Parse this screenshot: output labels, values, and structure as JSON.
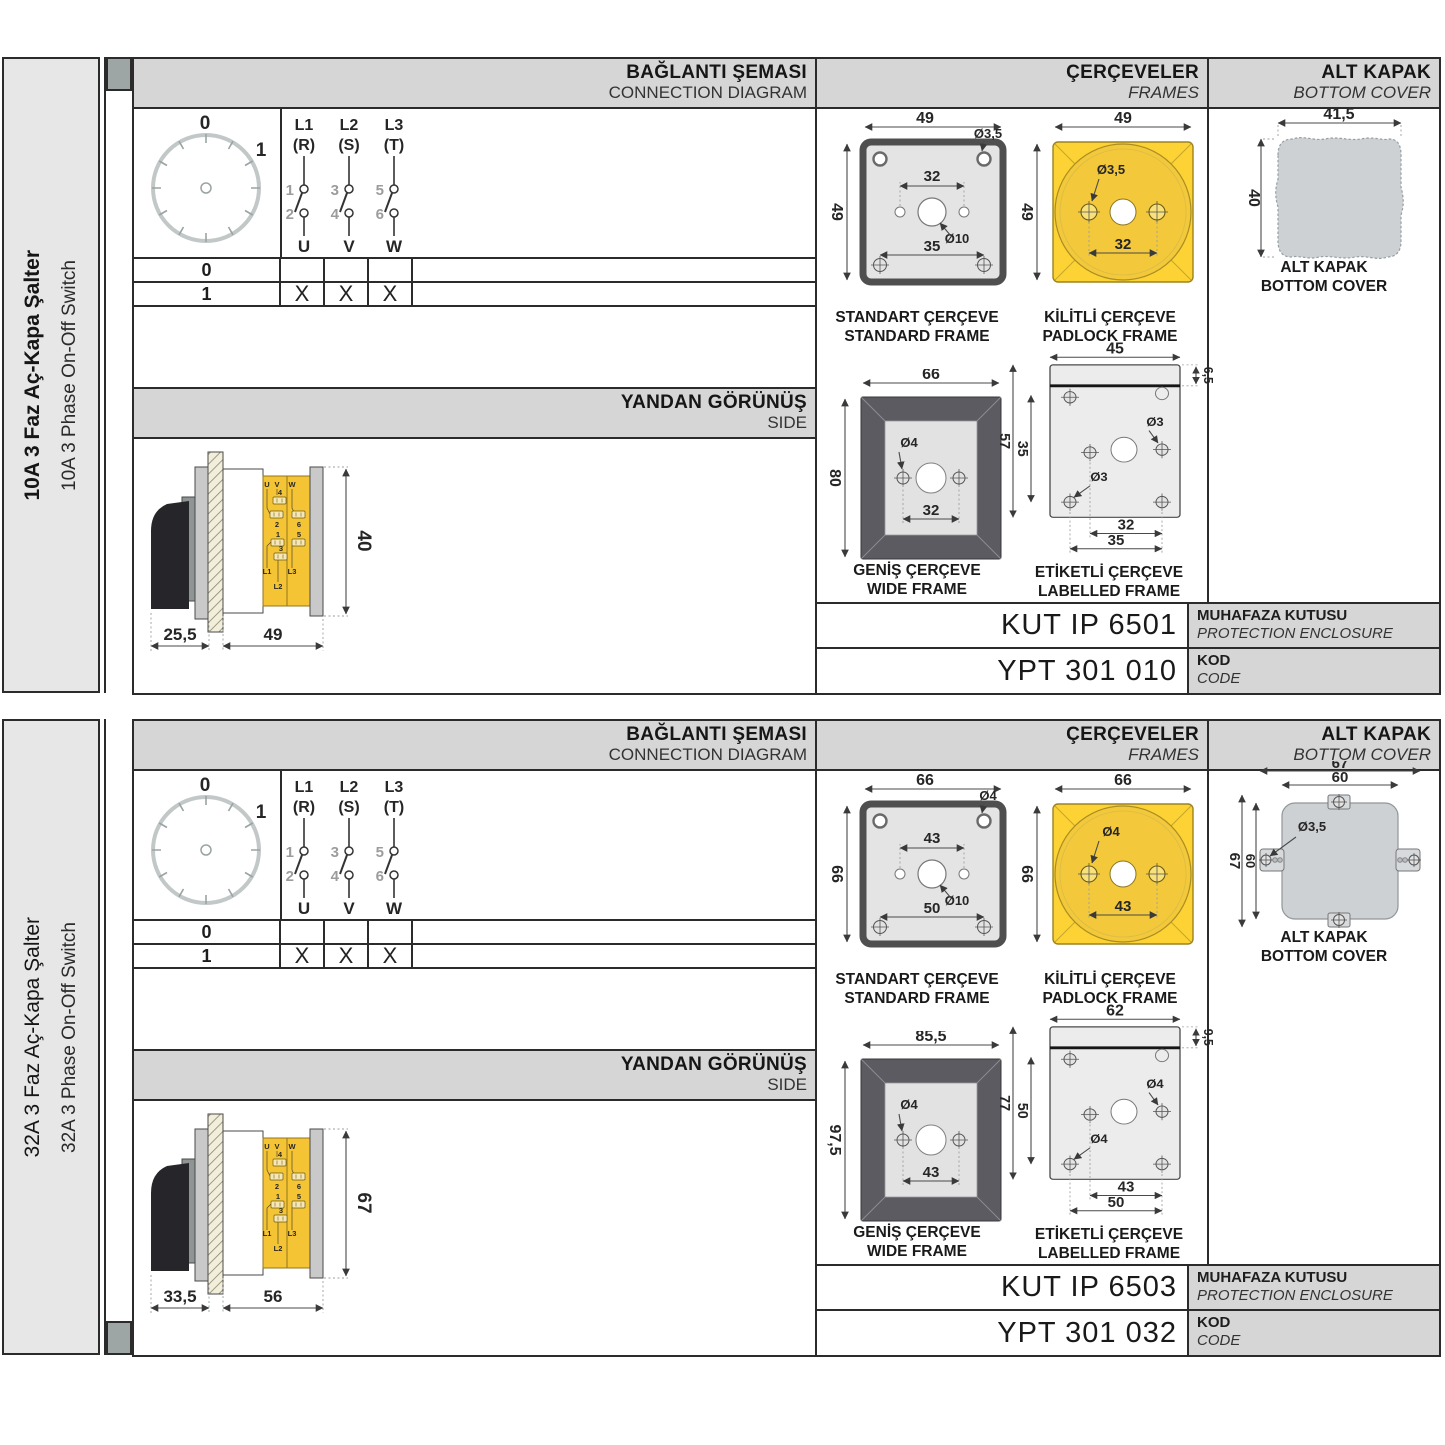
{
  "sections": [
    {
      "side_label": {
        "tr": "10A 3 Faz Aç-Kapa Şalter",
        "en": "10A 3 Phase On-Off Switch"
      },
      "headers": {
        "conn_tr": "BAĞLANTI ŞEMASI",
        "conn_en": "CONNECTION DIAGRAM",
        "frames_tr": "ÇERÇEVELER",
        "frames_en": "FRAMES",
        "cover_tr": "ALT KAPAK",
        "cover_en": "BOTTOM COVER",
        "side_tr": "YANDAN GÖRÜNÜŞ",
        "side_en": "SIDE"
      },
      "dial": {
        "p0": "0",
        "p1": "1"
      },
      "poles": [
        {
          "line": "L1",
          "phase": "(R)",
          "top": "1",
          "bot": "2",
          "out": "U"
        },
        {
          "line": "L2",
          "phase": "(S)",
          "top": "3",
          "bot": "4",
          "out": "V"
        },
        {
          "line": "L3",
          "phase": "(T)",
          "top": "5",
          "bot": "6",
          "out": "W"
        }
      ],
      "table": {
        "rows": [
          {
            "pos": "0",
            "m": [
              "",
              "",
              ""
            ]
          },
          {
            "pos": "1",
            "m": [
              "X",
              "X",
              "X"
            ]
          }
        ]
      },
      "side_view": {
        "dim_a": "25,5",
        "dim_b": "49",
        "dim_c": "40",
        "u": "U",
        "v": "V",
        "w": "W",
        "n1": "1",
        "n2": "2",
        "n3": "3",
        "n4": "4",
        "n5": "5",
        "n6": "6",
        "l1": "L1",
        "l2": "L2",
        "l3": "L3"
      },
      "frames": {
        "standard": {
          "label_tr": "STANDART ÇERÇEVE",
          "label_en": "STANDARD FRAME",
          "dim_w": "49",
          "dim_h": "49",
          "dim_holes": "32",
          "dim_lower": "35",
          "dia_corner": "Ø3,5",
          "dia_center": "Ø10"
        },
        "padlock": {
          "label_tr": "KİLİTLİ ÇERÇEVE",
          "label_en": "PADLOCK FRAME",
          "dim_w": "49",
          "dim_h": "49",
          "dia": "Ø3,5",
          "dim_holes": "32"
        },
        "wide": {
          "label_tr": "GENİŞ ÇERÇEVE",
          "label_en": "WIDE FRAME",
          "dim_w": "66",
          "dim_h": "80",
          "dia": "Ø4",
          "dim_holes": "32"
        },
        "labelled": {
          "label_tr": "ETİKETLİ ÇERÇEVE",
          "label_en": "LABELLED FRAME",
          "dim_w": "45",
          "dim_strip": "6,5",
          "dim_h": "57",
          "dim_inner": "35",
          "dia_a": "Ø3",
          "dia_b": "Ø3",
          "dim_b1": "32",
          "dim_b2": "35"
        }
      },
      "cover": {
        "label_tr": "ALT KAPAK",
        "label_en": "BOTTOM COVER",
        "dim_w": "41,5",
        "dim_h": "40",
        "dim_w1": "",
        "dim_w2": "",
        "dim_h1": "",
        "dim_h2": "",
        "dia": ""
      },
      "codes": {
        "enclosure_code": "KUT IP 6501",
        "enclosure_tr": "MUHAFAZA KUTUSU",
        "enclosure_en": "PROTECTION ENCLOSURE",
        "code": "YPT 301 010",
        "code_tr": "KOD",
        "code_en": "CODE"
      }
    },
    {
      "side_label": {
        "tr": "32A 3 Faz Aç-Kapa Şalter",
        "en": "32A 3 Phase On-Off Switch"
      },
      "headers": {
        "conn_tr": "BAĞLANTI ŞEMASI",
        "conn_en": "CONNECTION DIAGRAM",
        "frames_tr": "ÇERÇEVELER",
        "frames_en": "FRAMES",
        "cover_tr": "ALT KAPAK",
        "cover_en": "BOTTOM COVER",
        "side_tr": "YANDAN GÖRÜNÜŞ",
        "side_en": "SIDE"
      },
      "dial": {
        "p0": "0",
        "p1": "1"
      },
      "poles": [
        {
          "line": "L1",
          "phase": "(R)",
          "top": "1",
          "bot": "2",
          "out": "U"
        },
        {
          "line": "L2",
          "phase": "(S)",
          "top": "3",
          "bot": "4",
          "out": "V"
        },
        {
          "line": "L3",
          "phase": "(T)",
          "top": "5",
          "bot": "6",
          "out": "W"
        }
      ],
      "table": {
        "rows": [
          {
            "pos": "0",
            "m": [
              "",
              "",
              ""
            ]
          },
          {
            "pos": "1",
            "m": [
              "X",
              "X",
              "X"
            ]
          }
        ]
      },
      "side_view": {
        "dim_a": "33,5",
        "dim_b": "56",
        "dim_c": "67",
        "u": "U",
        "v": "V",
        "w": "W",
        "n1": "1",
        "n2": "2",
        "n3": "3",
        "n4": "4",
        "n5": "5",
        "n6": "6",
        "l1": "L1",
        "l2": "L2",
        "l3": "L3"
      },
      "frames": {
        "standard": {
          "label_tr": "STANDART ÇERÇEVE",
          "label_en": "STANDARD FRAME",
          "dim_w": "66",
          "dim_h": "66",
          "dim_holes": "43",
          "dim_lower": "50",
          "dia_corner": "Ø4",
          "dia_center": "Ø10"
        },
        "padlock": {
          "label_tr": "KİLİTLİ ÇERÇEVE",
          "label_en": "PADLOCK FRAME",
          "dim_w": "66",
          "dim_h": "66",
          "dia": "Ø4",
          "dim_holes": "43"
        },
        "wide": {
          "label_tr": "GENİŞ ÇERÇEVE",
          "label_en": "WIDE FRAME",
          "dim_w": "85,5",
          "dim_h": "97,5",
          "dia": "Ø4",
          "dim_holes": "43"
        },
        "labelled": {
          "label_tr": "ETİKETLİ ÇERÇEVE",
          "label_en": "LABELLED FRAME",
          "dim_w": "62",
          "dim_strip": "9,5",
          "dim_h": "77",
          "dim_inner": "50",
          "dia_a": "Ø4",
          "dia_b": "Ø4",
          "dim_b1": "43",
          "dim_b2": "50"
        }
      },
      "cover": {
        "label_tr": "ALT KAPAK",
        "label_en": "BOTTOM COVER",
        "dim_w": "",
        "dim_h": "",
        "dim_w1": "67",
        "dim_w2": "60",
        "dim_h1": "67",
        "dim_h2": "60",
        "dia": "Ø3,5"
      },
      "codes": {
        "enclosure_code": "KUT IP 6503",
        "enclosure_tr": "MUHAFAZA KUTUSU",
        "enclosure_en": "PROTECTION ENCLOSURE",
        "code": "YPT 301 032",
        "code_tr": "KOD",
        "code_en": "CODE"
      }
    }
  ]
}
